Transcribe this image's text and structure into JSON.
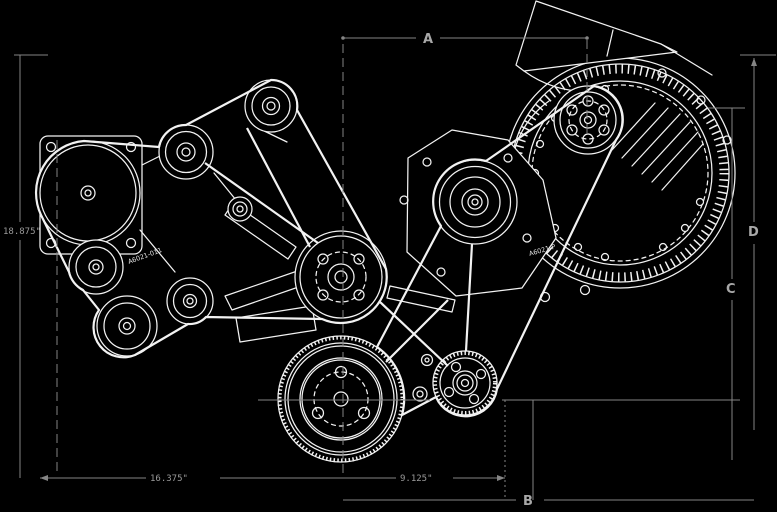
{
  "drawing": {
    "type": "engine-front-accessory-drive-cad-view",
    "dimension_labels": {
      "a": "A",
      "b": "B",
      "c": "C",
      "d": "D"
    },
    "measurements": {
      "left_height": "18.875\"",
      "bottom_left_width": "16.375\"",
      "bottom_right_width": "9.125\""
    },
    "part_numbers": {
      "left": "A6021-011",
      "right": "A6021-P"
    },
    "colors": {
      "background": "#000000",
      "geometry_line": "#f2f2f2",
      "dimension_line": "#858585",
      "dimension_text": "#a8a8a8"
    }
  }
}
